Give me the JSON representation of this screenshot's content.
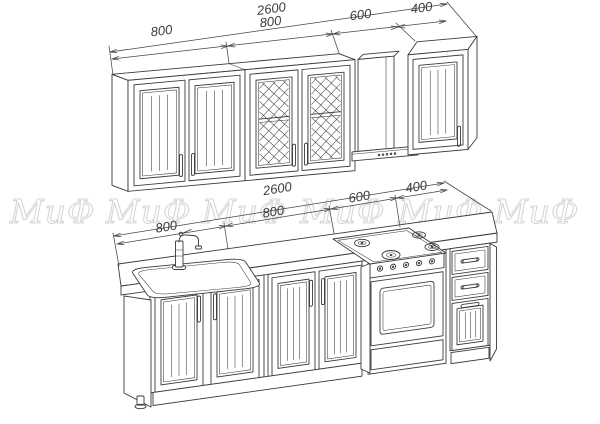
{
  "colors": {
    "line": "#3a3a3a",
    "dimension": "#454545",
    "watermark": "#d6d6d6",
    "background": "#ffffff"
  },
  "watermark": {
    "text": "МиФ"
  },
  "dims_top": {
    "total": "2600",
    "segments": [
      "800",
      "800",
      "600",
      "400"
    ]
  },
  "dims_bottom": {
    "total": "2600",
    "segments": [
      "800",
      "800",
      "600",
      "400"
    ]
  }
}
